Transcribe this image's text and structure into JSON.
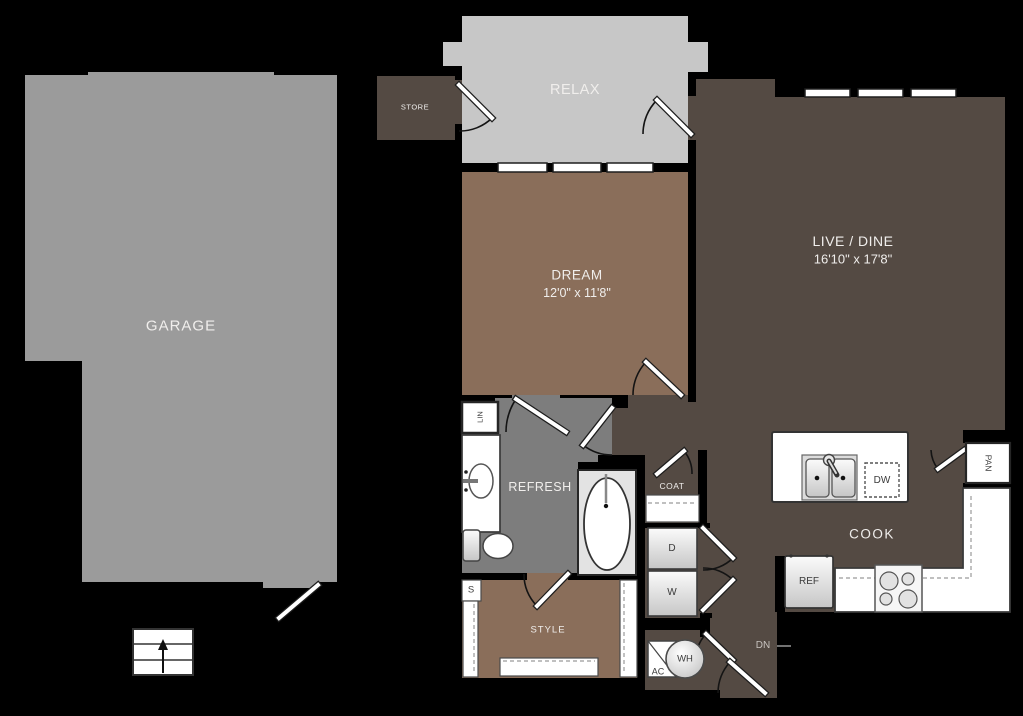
{
  "title": "Apartment floor plan",
  "colors": {
    "background": "#000000",
    "garage_gray": "#9b9b9b",
    "balcony_gray": "#c7c7c7",
    "bath_gray": "#7d7d7d",
    "bedroom_brown": "#8a6e5a",
    "living_dark_brown": "#544a43",
    "fixture_white": "#ffffff",
    "label_light": "#f0eeec",
    "label_dark": "#3a3a3a"
  },
  "rooms": {
    "garage": {
      "label": "GARAGE"
    },
    "relax": {
      "label": "RELAX"
    },
    "store": {
      "label": "STORE"
    },
    "dream": {
      "label": "DREAM",
      "dims": "12'0\" x 11'8\""
    },
    "live_dine": {
      "label": "LIVE / DINE",
      "dims": "16'10\" x 17'8\""
    },
    "refresh": {
      "label": "REFRESH"
    },
    "cook": {
      "label": "COOK"
    },
    "style": {
      "label": "STYLE"
    }
  },
  "closets": {
    "linen": {
      "label": "LIN"
    },
    "coat": {
      "label": "COAT"
    },
    "pantry": {
      "label": "PAN"
    },
    "shelf": {
      "label": "S"
    }
  },
  "appliances": {
    "dryer": {
      "label": "D"
    },
    "washer": {
      "label": "W"
    },
    "dishwasher": {
      "label": "DW"
    },
    "refrigerator": {
      "label": "REF"
    },
    "water_heater": {
      "label": "WH"
    },
    "air_handler": {
      "label": "AC"
    }
  },
  "annotations": {
    "stairs_down": {
      "label": "DN"
    }
  }
}
